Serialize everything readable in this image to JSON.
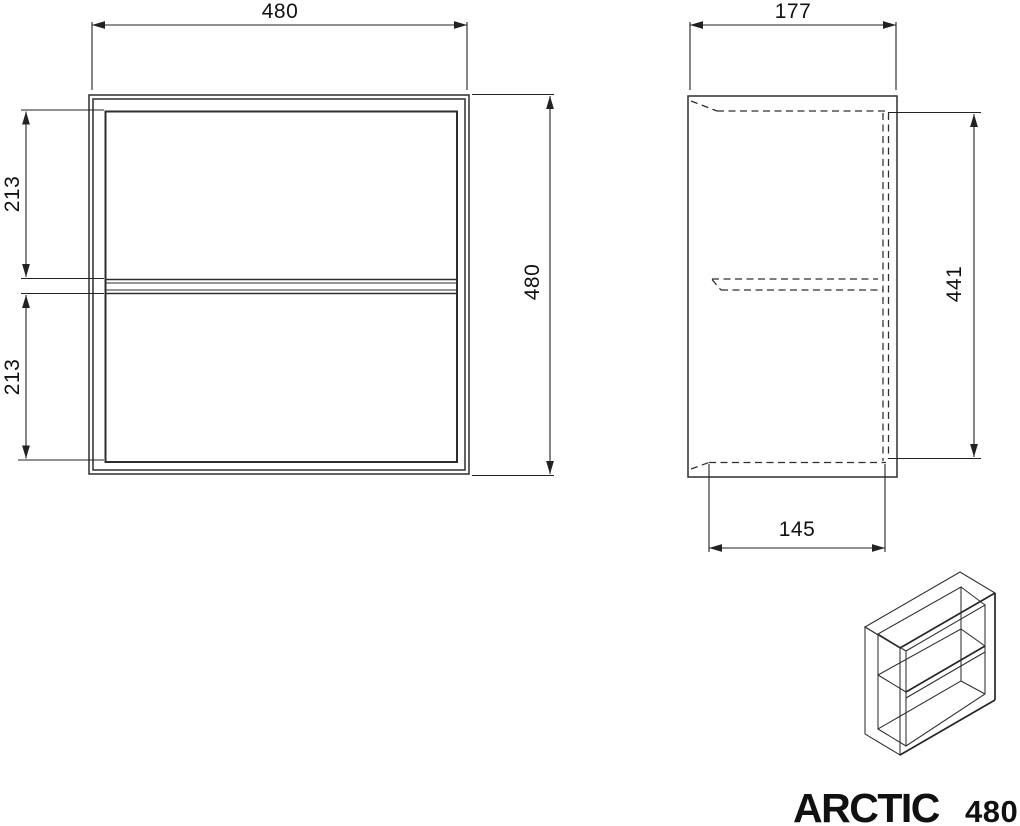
{
  "product_title": {
    "brand": "ARCTIC",
    "model": "480"
  },
  "front_view": {
    "width_label": "480",
    "height_label": "480",
    "upper_compartment_label": "213",
    "lower_compartment_label": "213"
  },
  "side_view": {
    "depth_label": "177",
    "interior_height_label": "441",
    "interior_depth_label": "145"
  },
  "colors": {
    "background": "#ffffff",
    "object_line": "#2e2e2e",
    "dimension_line": "#222222",
    "text": "#111111"
  }
}
